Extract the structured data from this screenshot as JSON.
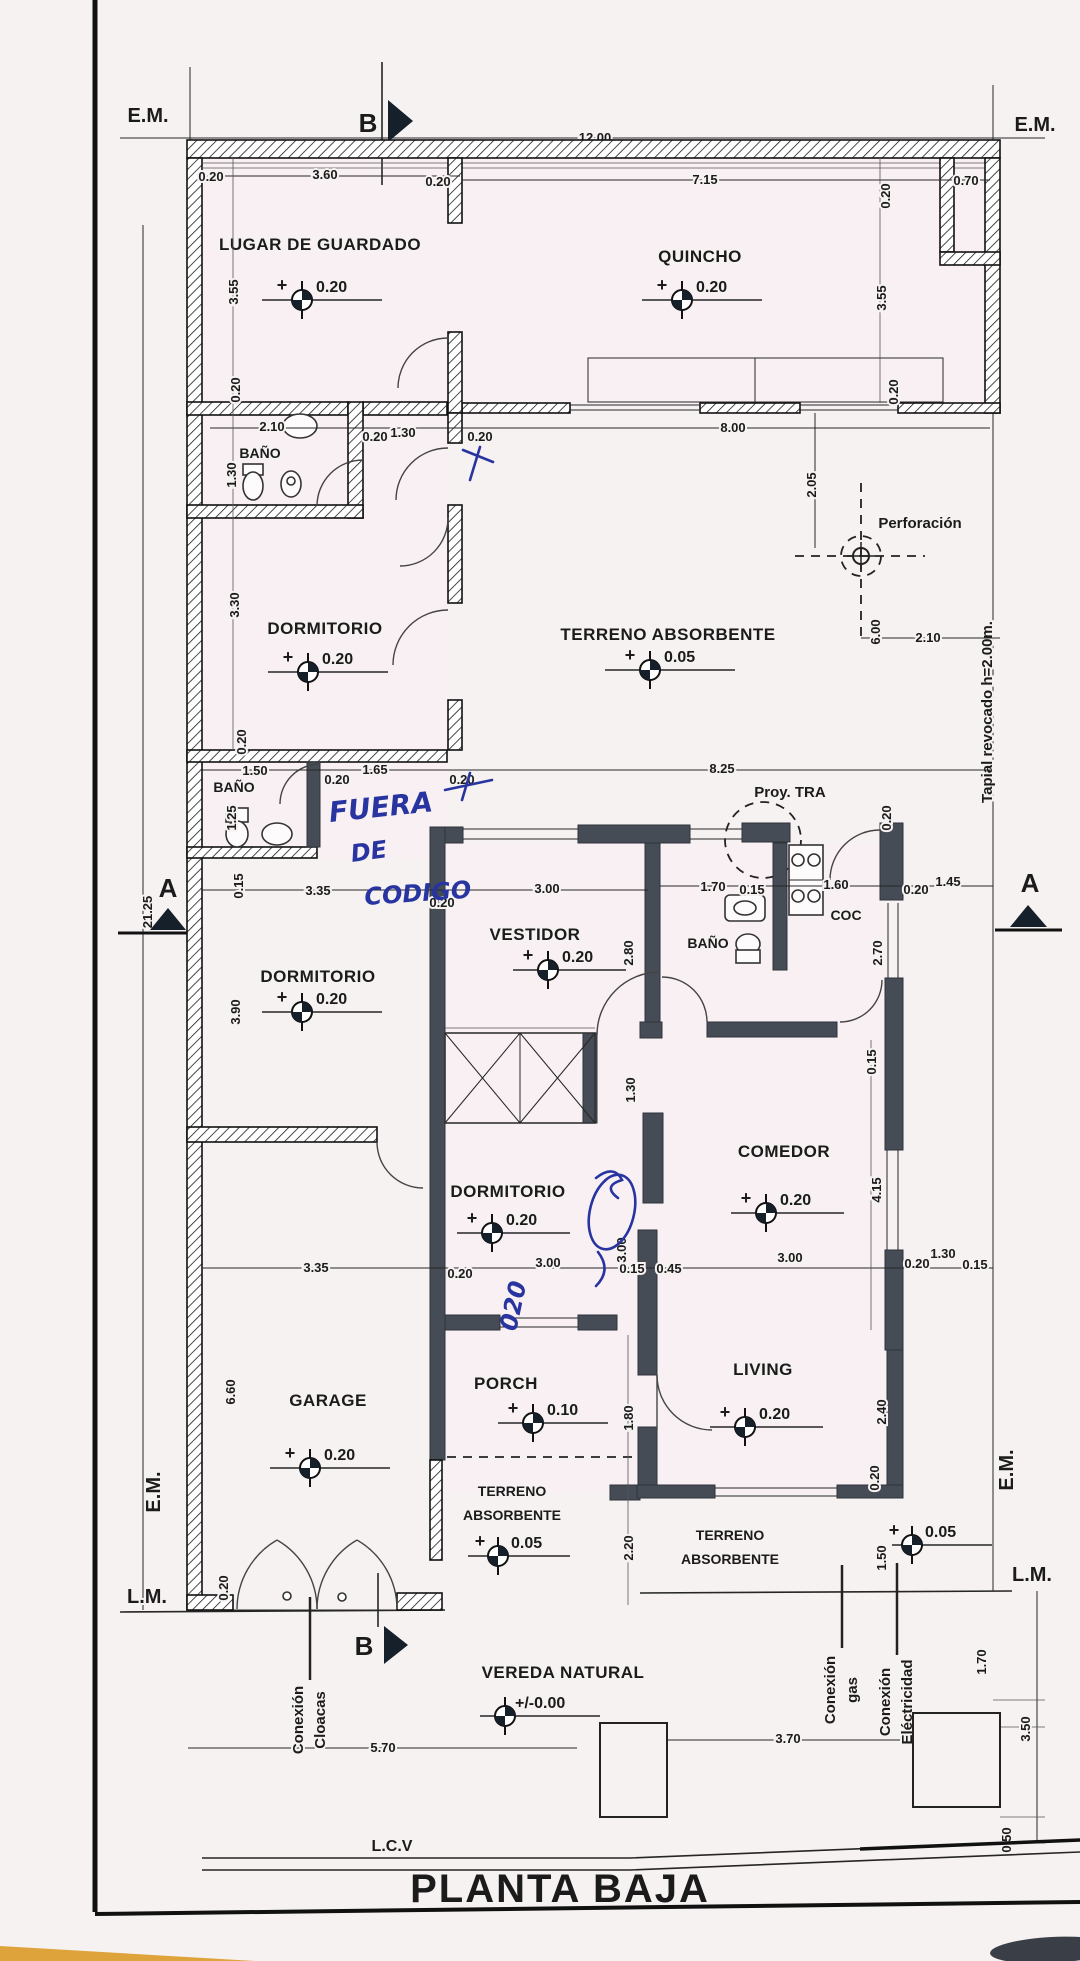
{
  "title": "PLANTA BAJA",
  "site": {
    "em": "E.M.",
    "lm": "L.M.",
    "lcv": "L.C.V",
    "tapial": "Tapial revocado h=2.00m.",
    "vereda": "VEREDA NATURAL",
    "perforacion": "Perforación",
    "proy_tra": "Proy. TRA",
    "conexion": "Conexión",
    "cloacas": "Cloacas",
    "gas": "gas",
    "electricidad": "Eléctricidad"
  },
  "markers": {
    "a": "A",
    "b": "B"
  },
  "rooms": {
    "lugar": "LUGAR DE GUARDADO",
    "quincho": "QUINCHO",
    "banio": "BAÑO",
    "dormitorio": "DORMITORIO",
    "vestidor": "VESTIDOR",
    "cocina": "COC",
    "comedor": "COMEDOR",
    "garage": "GARAGE",
    "porch": "PORCH",
    "living": "LIVING",
    "terreno": "TERRENO ABSORBENTE",
    "terreno_1": "TERRENO",
    "terreno_2": "ABSORBENTE"
  },
  "levels": {
    "plus": "+",
    "p020": "0.20",
    "p010": "0.10",
    "p005": "0.05",
    "zero": "+/-0.00"
  },
  "handwriting": {
    "l1": "FUERA",
    "l2": "DE",
    "l3": "CODIGO",
    "scribble": "020"
  },
  "dims": {
    "d0_15": "0.15",
    "d0_20": "0.20",
    "d0_45": "0.45",
    "d0_50": "0.50",
    "d0_70": "0.70",
    "d1_25": "1.25",
    "d1_30": "1.30",
    "d1_45": "1.45",
    "d1_50": "1.50",
    "d1_60": "1.60",
    "d1_65": "1.65",
    "d1_70": "1.70",
    "d1_80": "1.80",
    "d2_05": "2.05",
    "d2_10": "2.10",
    "d2_20": "2.20",
    "d2_40": "2.40",
    "d2_70": "2.70",
    "d2_80": "2.80",
    "d3_00": "3.00",
    "d3_30": "3.30",
    "d3_35": "3.35",
    "d3_50": "3.50",
    "d3_55": "3.55",
    "d3_60": "3.60",
    "d3_70": "3.70",
    "d3_90": "3.90",
    "d4_15": "4.15",
    "d5_70": "5.70",
    "d6_00": "6.00",
    "d6_60": "6.60",
    "d7_15": "7.15",
    "d8_00": "8.00",
    "d8_25": "8.25",
    "d12_00": "12.00",
    "d21_25": "21.25"
  }
}
